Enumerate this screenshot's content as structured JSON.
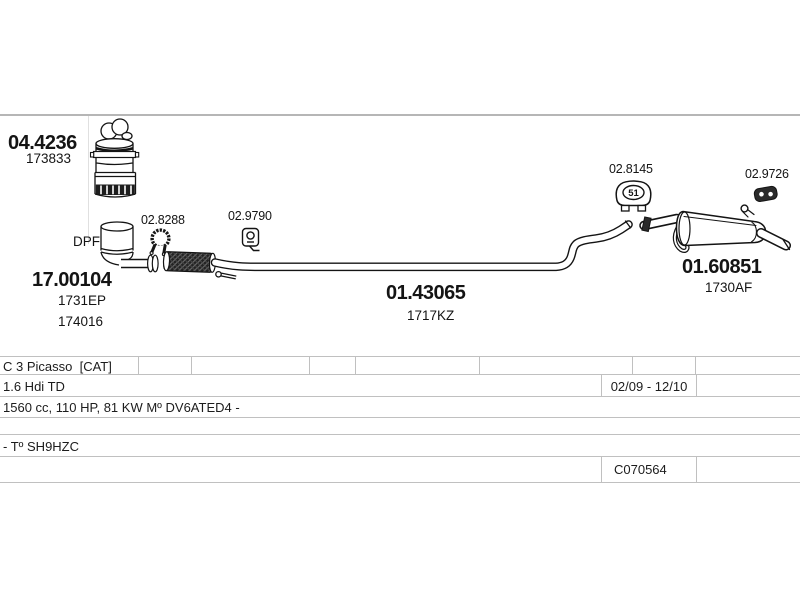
{
  "page": {
    "divider_color": "#b6b6b6",
    "table_border_color": "#c0c0c0",
    "drawing_color": "#141414"
  },
  "labels": {
    "catalyst": {
      "number": "04.4236",
      "ref": "173833"
    },
    "dpf_tag": "DPF",
    "dpf": {
      "number": "17.00104",
      "ref1": "1731EP",
      "ref2": "174016"
    },
    "clamp": {
      "number": "02.8288"
    },
    "bracket": {
      "number": "02.9790"
    },
    "pipe": {
      "number": "01.43065",
      "ref": "1717KZ"
    },
    "hanger": {
      "number": "02.8145",
      "size": "51"
    },
    "mount": {
      "number": "02.9726"
    },
    "muffler": {
      "number": "01.60851",
      "ref": "1730AF"
    }
  },
  "icons": {
    "clamp": "pipe-clamp-icon",
    "bracket": "hanger-bracket-icon",
    "hanger": "rubber-hanger-icon",
    "mount": "rubber-mount-icon"
  },
  "table": {
    "model": "C 3 Picasso  [CAT]",
    "engine": "1.6 Hdi TD",
    "years": "02/09 - 12/10",
    "specs": "1560 cc, 110 HP, 81 KW Mº DV6ATED4 -",
    "type_code": "- Tº SH9HZC",
    "chassis_code": "C070564"
  }
}
